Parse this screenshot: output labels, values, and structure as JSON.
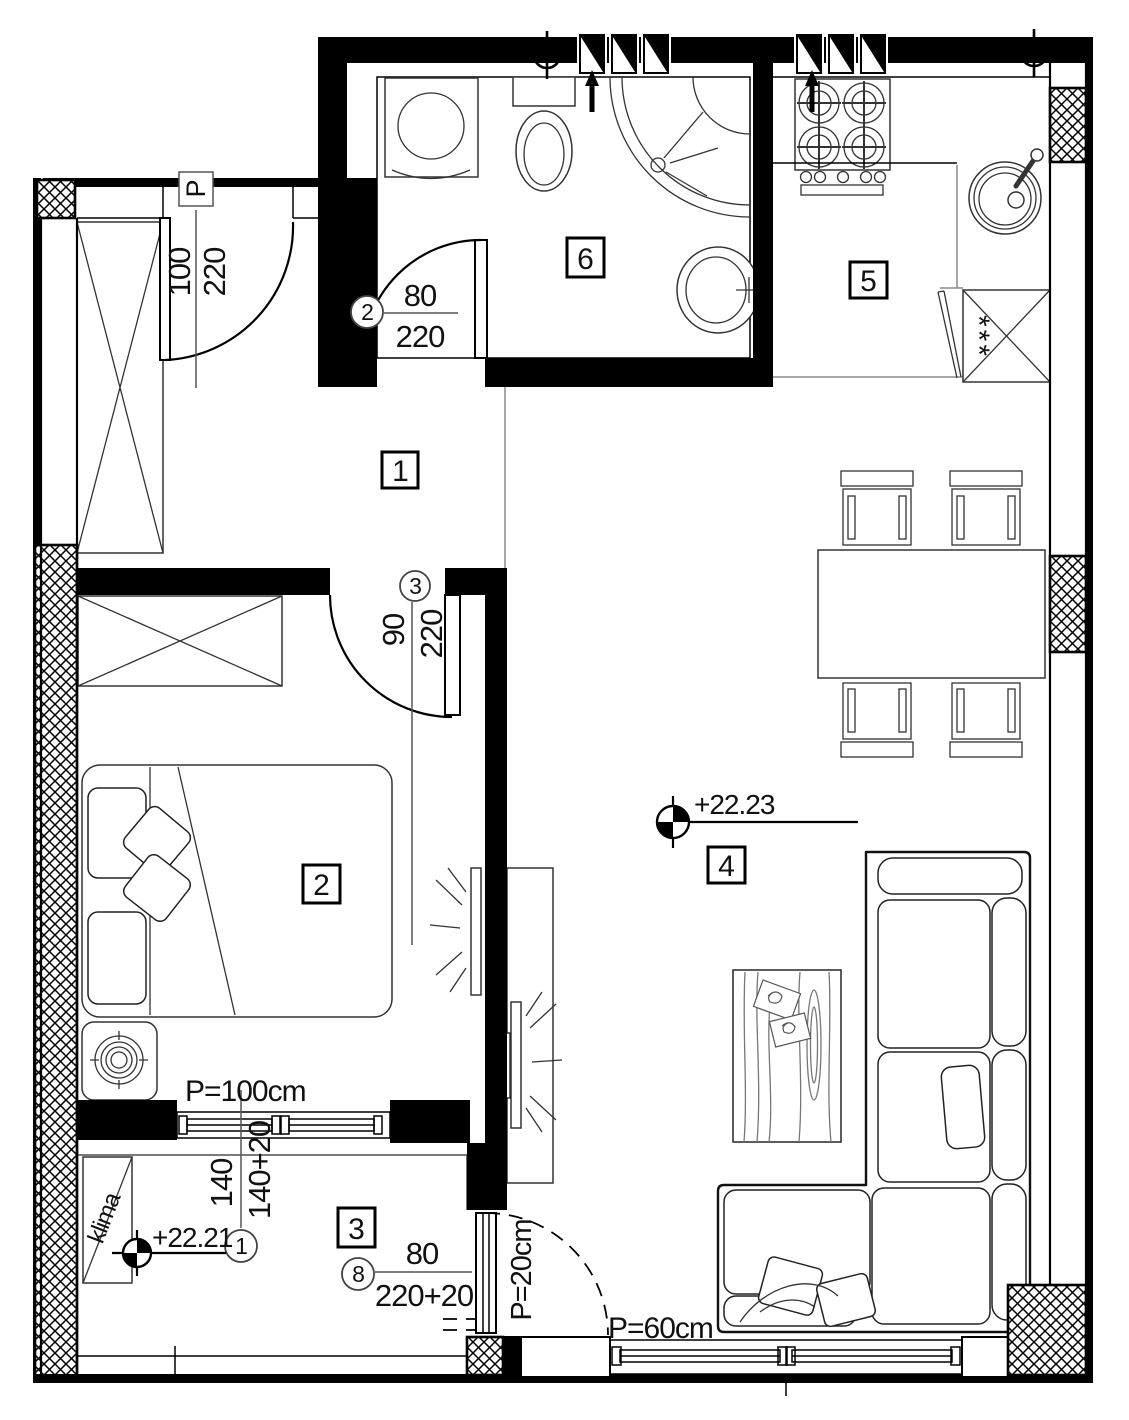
{
  "plan": {
    "rooms": {
      "hall": "1",
      "bedroom": "2",
      "balcony": "3",
      "living": "4",
      "kitchen": "5",
      "bathroom": "6"
    },
    "doors": {
      "entrance": {
        "mark": "P",
        "width": "100",
        "height": "220"
      },
      "bathroom": {
        "no": "2",
        "width": "80",
        "height": "220"
      },
      "bedroom": {
        "no": "3",
        "width": "90",
        "height": "220"
      },
      "balcony": {
        "no": "8",
        "width": "80",
        "height": "220+20"
      }
    },
    "window": {
      "no": "1",
      "width": "140",
      "height": "140+20"
    },
    "levels": {
      "living": "+22.23",
      "balcony": "+22.21"
    },
    "parapets": {
      "bedroom_window": "P=100cm",
      "balcony_door": "P=20cm",
      "living_window": "P=60cm"
    },
    "equipment": {
      "ac": "klima",
      "fridge": "***"
    }
  }
}
